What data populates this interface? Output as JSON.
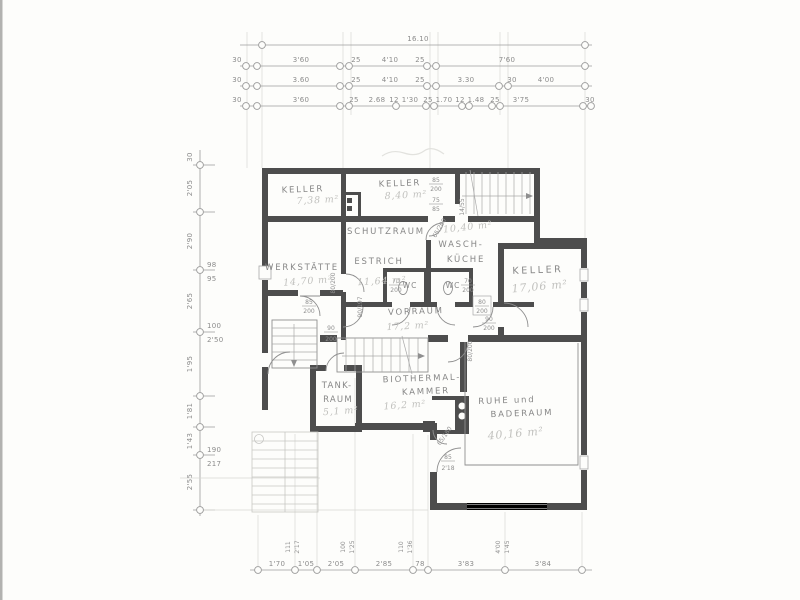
{
  "dims_top": {
    "total": "16.10",
    "row2": [
      "30",
      "3'60",
      "25",
      "4'10",
      "25",
      "7'60"
    ],
    "row3": [
      "30",
      "3.60",
      "25",
      "4'10",
      "25",
      "3.30",
      "30",
      "4'00"
    ],
    "row4": [
      "30",
      "3'60",
      "25",
      "2.68",
      "12",
      "1'30",
      "25",
      "1.70",
      "12",
      "1.48",
      "25",
      "3'75",
      "30"
    ]
  },
  "dims_left": {
    "rot": [
      "30",
      "2'05",
      "2'90",
      "2'65",
      "1'95",
      "1'81",
      "1'43",
      "2'55"
    ],
    "pair1": [
      "98",
      "95"
    ],
    "pair2": [
      "100",
      "2'50"
    ],
    "pair3": [
      "190",
      "217"
    ]
  },
  "dims_bottom": {
    "row": [
      "1'70",
      "1'05",
      "2'05",
      "2'85",
      "78",
      "3'83",
      "3'84"
    ],
    "pair1": [
      "111",
      "2'17"
    ],
    "pair2": [
      "100",
      "1'25"
    ],
    "pair3": [
      "110",
      "1'36"
    ],
    "pair4": [
      "4'00",
      "1'45"
    ]
  },
  "rooms": {
    "keller_left": {
      "name": "KELLER",
      "area": "7,38 m²"
    },
    "keller_mid": {
      "name": "KELLER",
      "area": "8,40 m²"
    },
    "werkstaette": {
      "name": "WERKSTÄTTE",
      "area": "14,70 m²"
    },
    "schutzraum": {
      "name": "SCHUTZRAUM",
      "name2": "ESTRICH",
      "area": "11,64 m²"
    },
    "waschkueche": {
      "name": "WASCH-",
      "name2": "KÜCHE",
      "area": "10,40 m²"
    },
    "wc_left": {
      "name": "WC"
    },
    "wc_right": {
      "name": "WC"
    },
    "keller_right": {
      "name": "KELLER",
      "area": "17,06 m²"
    },
    "vorraum": {
      "name": "VORRAUM",
      "area": "17,2 m²"
    },
    "tankraum": {
      "name": "TANK-",
      "name2": "RAUM",
      "area": "5,1 m²"
    },
    "biothermal": {
      "name": "BIOTHERMAL-",
      "name2": "KAMMER",
      "area": "16,2 m²"
    },
    "ruhe": {
      "name": "RUHE und",
      "name2": "BADERAUM",
      "area": "40,16 m²"
    }
  },
  "doors": {
    "top": {
      "w": "85",
      "h": "200"
    },
    "top_window": {
      "w": "75",
      "h": "85"
    },
    "stair_window": {
      "label": "14/55"
    },
    "waschkueche": {
      "label": "65/200"
    },
    "wc_left": {
      "w": "70",
      "h": "200"
    },
    "wc_right": {
      "w": "70",
      "h": "200"
    },
    "corridor": {
      "w": "80",
      "h": "200"
    },
    "keller_right": {
      "w": "90",
      "h": "200"
    },
    "werkstaette": {
      "w": "85",
      "h": "200"
    },
    "schutzraum": {
      "label": "80/200"
    },
    "vorraum_left": {
      "label": "90/197"
    },
    "stairs_inner": {
      "w": "90",
      "h": "200"
    },
    "biothermal": {
      "label": "80/200"
    },
    "sauna": {
      "label": "65/180"
    },
    "baderaum": {
      "w": "85",
      "h": "2'18"
    }
  }
}
